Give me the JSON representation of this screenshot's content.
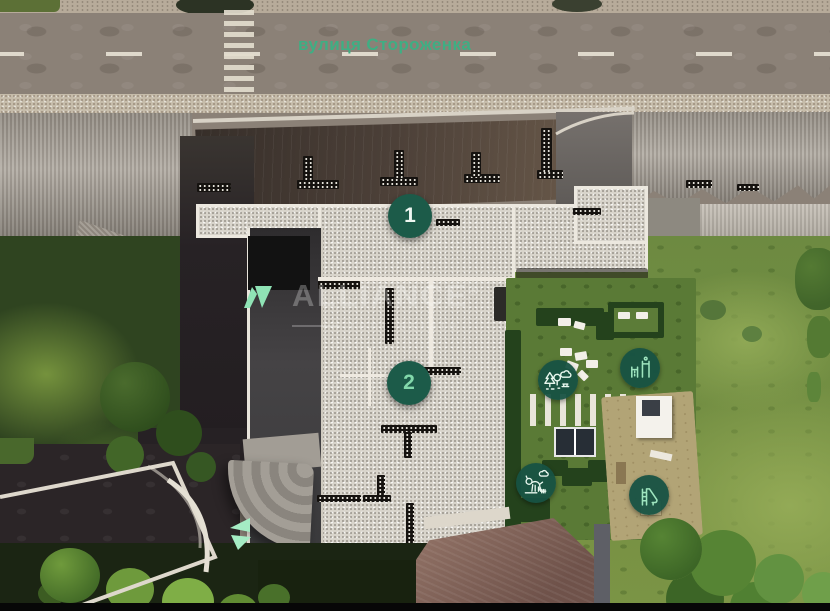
{
  "street": {
    "name": "вулиця Стороженка"
  },
  "watermark": {
    "brand": "ALLIANCE",
    "registered": "®",
    "tagline": "rent estate"
  },
  "markers": [
    {
      "id": "building-1",
      "label": "1"
    },
    {
      "id": "building-2",
      "label": "2"
    }
  ],
  "amenities": [
    {
      "name": "park-trees-icon",
      "meaning": "green zone / park"
    },
    {
      "name": "workout-bars-icon",
      "meaning": "sports ground"
    },
    {
      "name": "dog-walk-icon",
      "meaning": "dog walking area"
    },
    {
      "name": "playground-slide-icon",
      "meaning": "children playground"
    }
  ],
  "entrance": {
    "name": "entrance-arrows"
  },
  "colors": {
    "marker_bg": "#1c5b49",
    "mint": "#8fe3b5",
    "street_label": "#3fae83",
    "watermark_text": "rgba(250,252,250,0.28)"
  }
}
